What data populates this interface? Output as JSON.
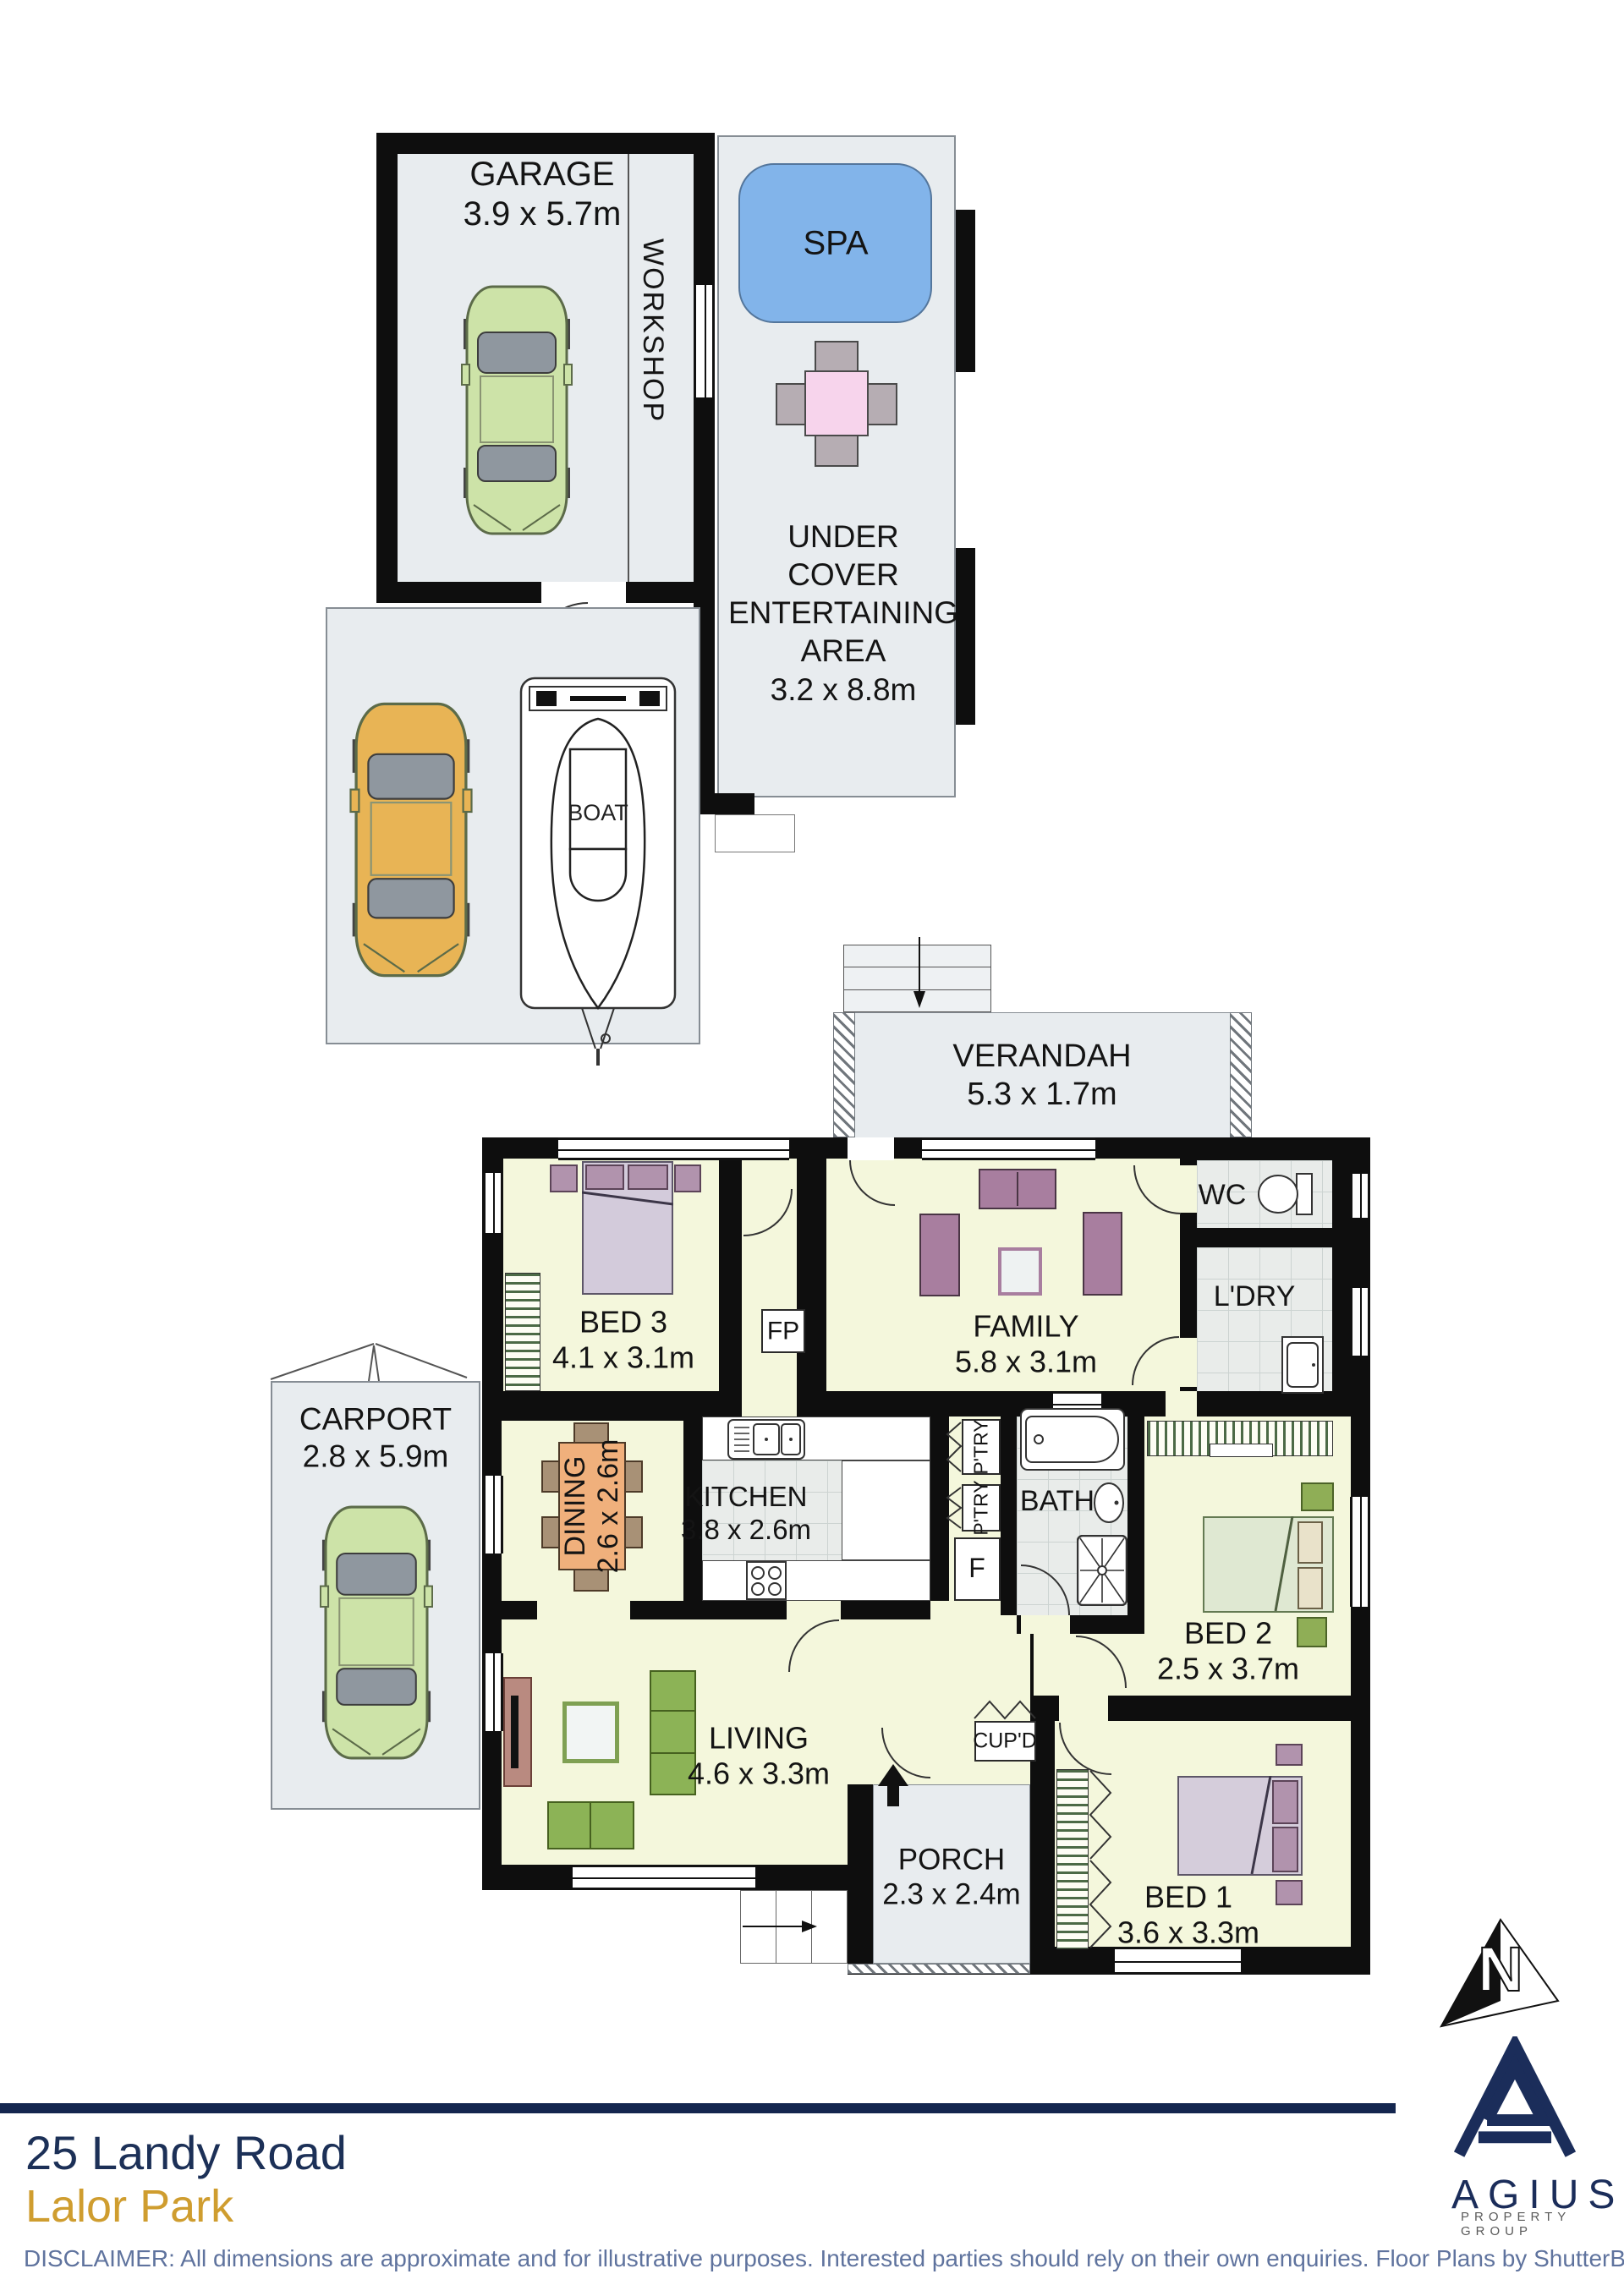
{
  "meta": {
    "address_line1": "25 Landy Road",
    "address_line2": "Lalor Park",
    "disclaimer": "DISCLAIMER: All dimensions are approximate and for illustrative purposes. Interested parties should rely on their own enquiries. Floor Plans by ShutterBooth Sydney."
  },
  "logo": {
    "brand": "AGIUS",
    "tagline": "PROPERTY GROUP"
  },
  "compass": {
    "north": "N"
  },
  "colors": {
    "wall": "#0e0e0e",
    "room_fill": "#f4f7dc",
    "outdoor_fill": "#e8ecef",
    "spa_blue": "#82b4ea",
    "navy": "#1c3057",
    "gold": "#cf9d2f"
  },
  "rooms": {
    "garage": {
      "name": "GARAGE",
      "dims": "3.9 x 5.7m"
    },
    "workshop": {
      "name": "WORKSHOP"
    },
    "spa": {
      "name": "SPA"
    },
    "entertaining": {
      "line1": "UNDER",
      "line2": "COVER",
      "line3": "ENTERTAINING",
      "line4": "AREA",
      "dims": "3.2 x 8.8m"
    },
    "boat": {
      "name": "BOAT"
    },
    "verandah": {
      "name": "VERANDAH",
      "dims": "5.3 x 1.7m"
    },
    "wc": {
      "name": "WC"
    },
    "laundry": {
      "name": "L'DRY"
    },
    "bed3": {
      "name": "BED 3",
      "dims": "4.1 x 3.1m"
    },
    "fireplace": {
      "name": "FP"
    },
    "family": {
      "name": "FAMILY",
      "dims": "5.8 x 3.1m"
    },
    "carport": {
      "name": "CARPORT",
      "dims": "2.8 x 5.9m"
    },
    "dining": {
      "name": "DINING",
      "dims": "2.6 x 2.6m"
    },
    "kitchen": {
      "name": "KITCHEN",
      "dims": "3.8 x 2.6m"
    },
    "pantry": {
      "name": "P'TRY"
    },
    "fridge": {
      "name": "F"
    },
    "bath": {
      "name": "BATH"
    },
    "bed2": {
      "name": "BED 2",
      "dims": "2.5 x 3.7m"
    },
    "living": {
      "name": "LIVING",
      "dims": "4.6 x 3.3m"
    },
    "cupboard": {
      "name": "CUP'D"
    },
    "porch": {
      "name": "PORCH",
      "dims": "2.3 x 2.4m"
    },
    "bed1": {
      "name": "BED 1",
      "dims": "3.6 x 3.3m"
    }
  }
}
